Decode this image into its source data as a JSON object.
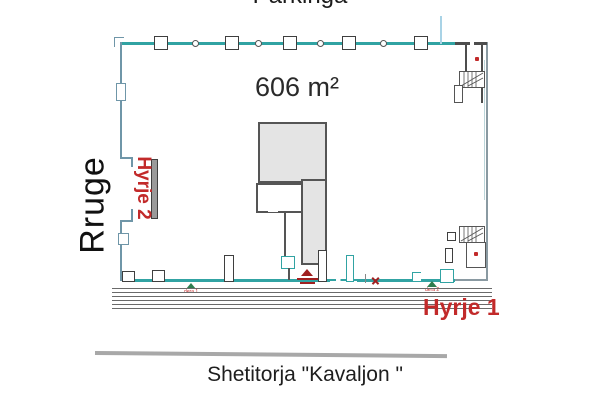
{
  "labels": {
    "street_top": "Parkinga",
    "area": "606 m²",
    "street_left": "Rruge",
    "entrance2": "Hyrje 2",
    "entrance1": "Hyrje 1",
    "street_bottom": "Shetitorja \"Kavaljon \"",
    "door1": "dera 1",
    "door2": "dera 2"
  },
  "colors": {
    "wall_teal": "#31a3a3",
    "wall_blue": "#6f96a8",
    "wall_dark": "#4d4d4d",
    "core_fill": "#e4e4e4",
    "red": "#c22a2a",
    "red_dark": "#a02020",
    "green": "#2e7d4f",
    "sep_gray": "#a8a8a8",
    "light_blue": "#a9d3e6",
    "walk_gray": "#6a6a6a"
  },
  "plan": {
    "top_wall": {
      "columns_x": [
        161,
        232,
        290,
        349,
        421
      ],
      "circles_x": [
        195,
        258,
        320,
        383
      ]
    },
    "walkway": {
      "lines": 6
    }
  }
}
